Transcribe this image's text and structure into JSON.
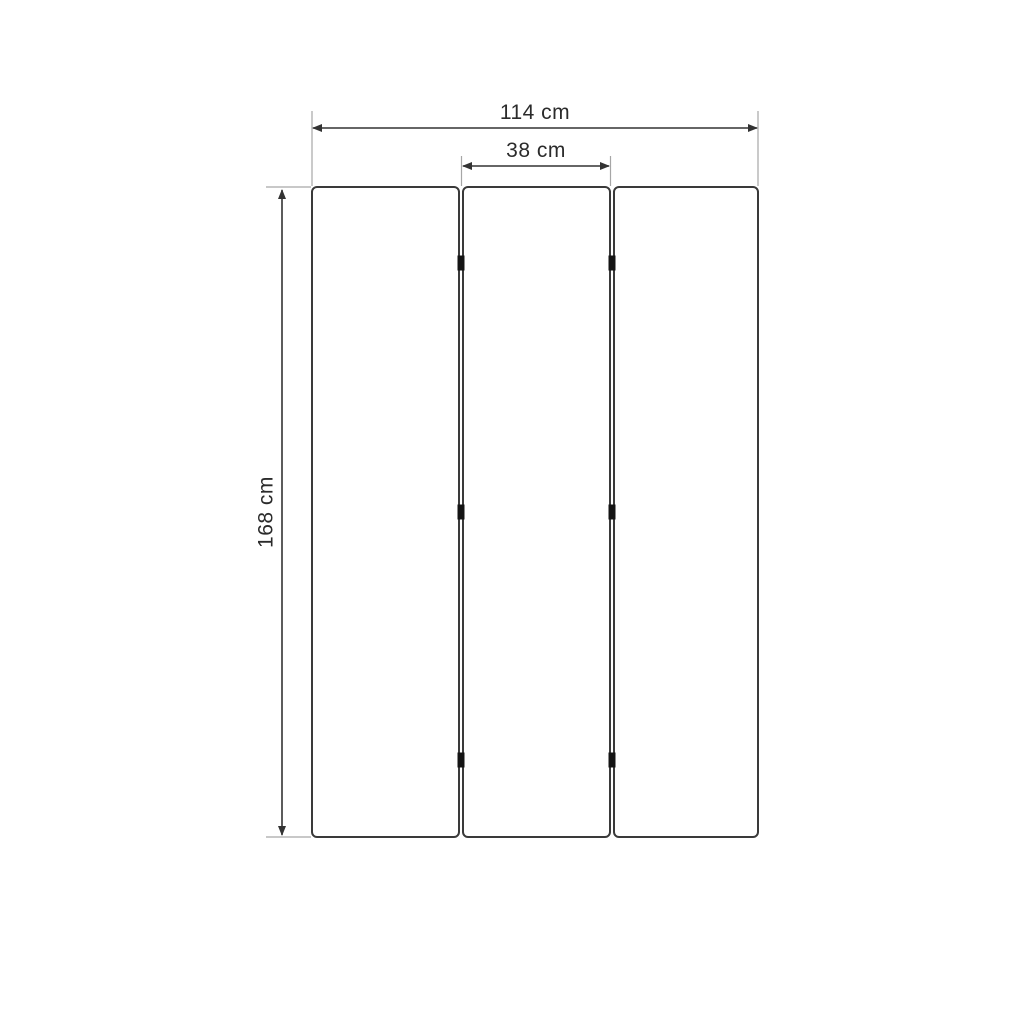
{
  "diagram": {
    "type": "furniture-dimension-drawing",
    "subject": "three-panel folding screen, front view",
    "panels": {
      "count": 3,
      "hinge_marks_per_junction": 3
    },
    "dimensions": {
      "total_width": {
        "label": "114 cm",
        "value_cm": 114
      },
      "panel_width": {
        "label": "38 cm",
        "value_cm": 38
      },
      "height": {
        "label": "168 cm",
        "value_cm": 168
      }
    },
    "colors": {
      "background": "#ffffff",
      "panel_outline": "#3a3a3a",
      "dimension_line": "#333333",
      "extension_line": "#a6a6a6",
      "hinge": "#141414",
      "text": "#2b2b2b"
    }
  }
}
